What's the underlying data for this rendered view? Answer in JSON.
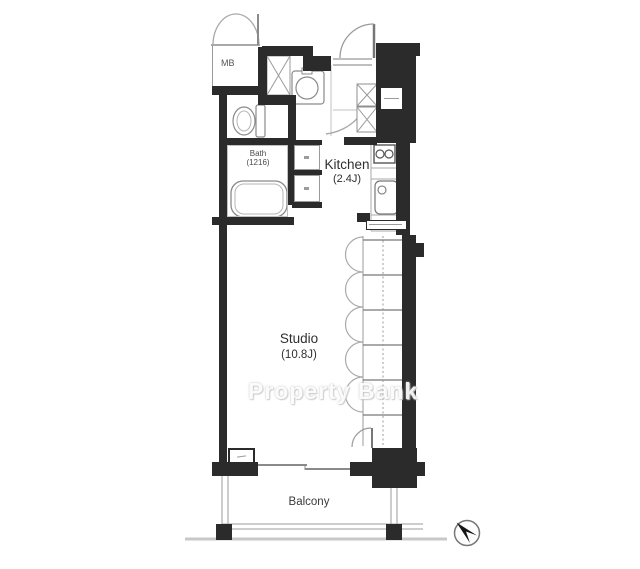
{
  "plan": {
    "watermark": "Property Bank",
    "rooms": {
      "studio": {
        "name": "Studio",
        "size": "(10.8J)"
      },
      "kitchen": {
        "name": "Kitchen",
        "size": "(2.4J)"
      },
      "bath": {
        "name": "Bath",
        "size": "(1216)"
      },
      "balcony": {
        "name": "Balcony"
      },
      "meter_box": {
        "label": "MB"
      }
    },
    "colors": {
      "wall": "#2b2b2b",
      "thin_line": "#9b9b9b",
      "label_text": "#3a3a3a",
      "watermark_text": "#fbfbfb",
      "ground_line": "#c8c8c8"
    },
    "icons": {
      "compass": "north-arrow-compass"
    }
  }
}
